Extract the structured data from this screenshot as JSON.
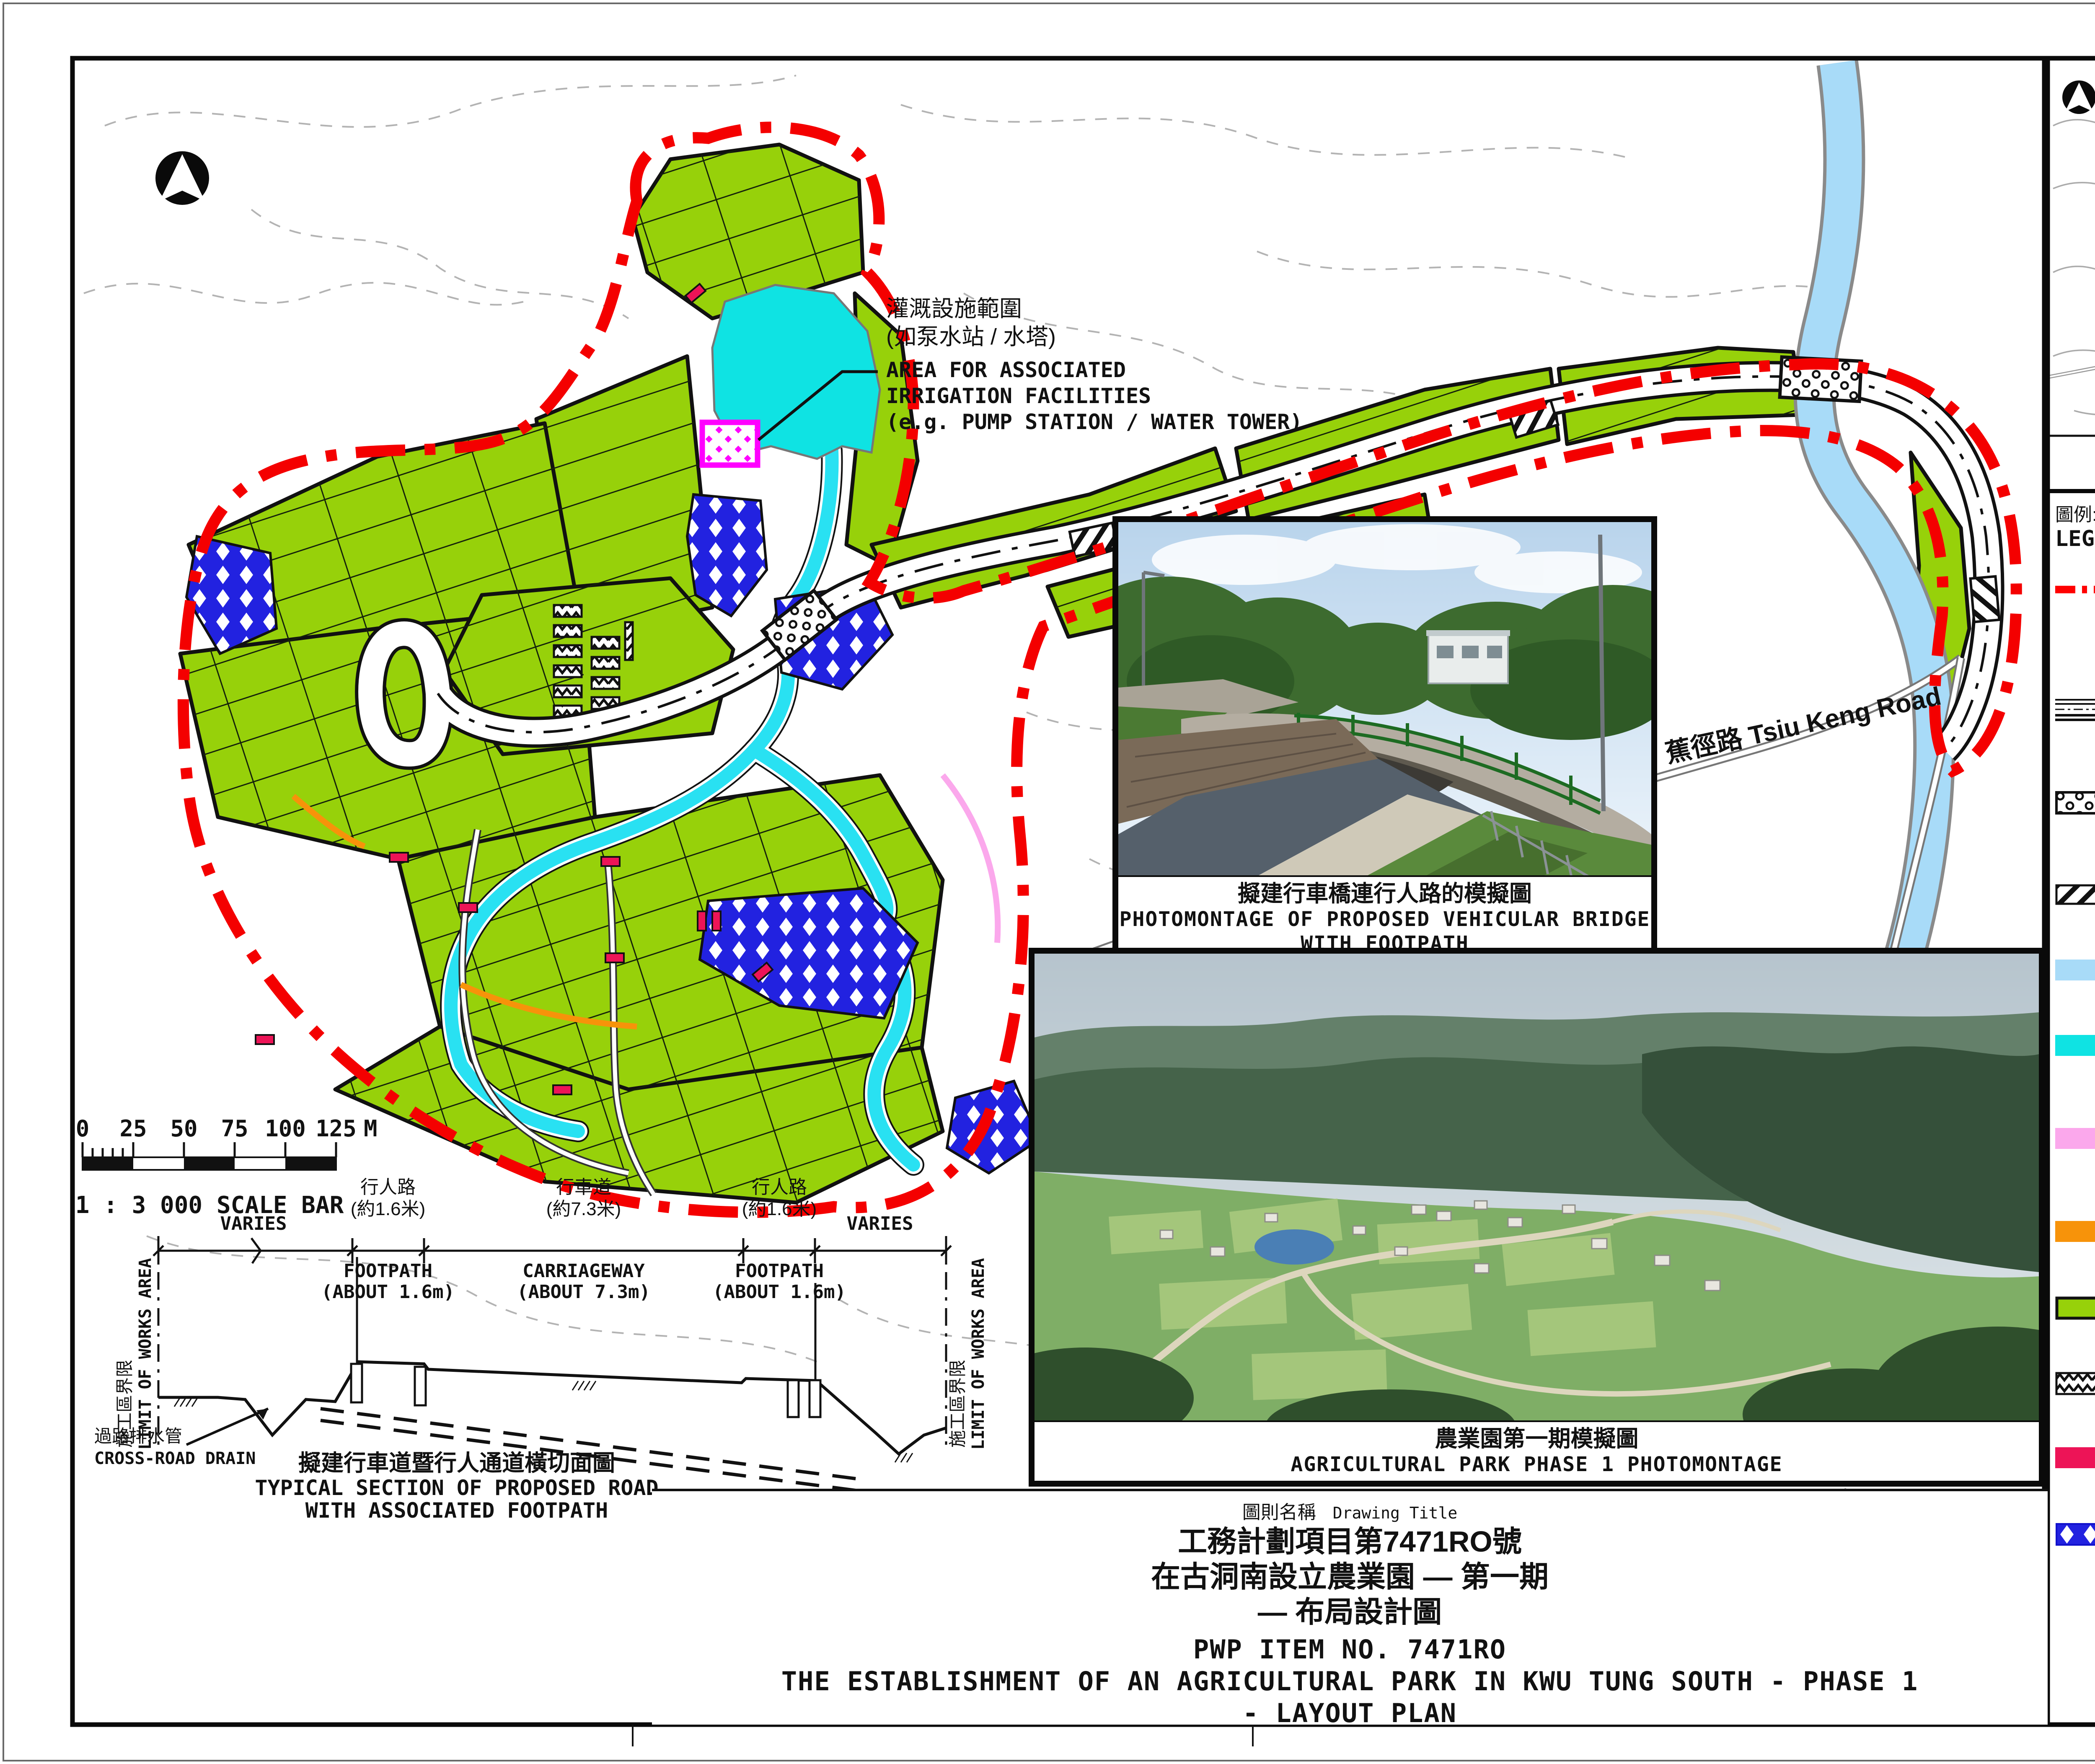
{
  "page": {
    "enclosure_label": "附件1 ENCLOSURE 1"
  },
  "key_plan": {
    "place1_zh": "長瀝",
    "place1_en": "Cheung Lek",
    "place2_zh": "蓮塘尾",
    "place2_en": "Lin Tong Mei",
    "place3_zh": "蕉徑",
    "place3_en": "Tsiu Keng",
    "caption_zh": "索引圖",
    "caption_en": "KEY PLAN"
  },
  "legend": {
    "header_zh": "圖例:",
    "header_en": "LEGEND:",
    "items": [
      {
        "id": "boundary",
        "zh": "農業園第一期擬議範圍",
        "en": "BOUNDARY OF PROPOSED AGRICULTURAL PARK",
        "en2": "(PHASE 1)",
        "color": "#ff0000"
      },
      {
        "id": "road",
        "zh": "擬建行車道暨行人通道",
        "en": "PROPOSED ROAD WITH ASSOCIATED FOOTPATH",
        "color": "#111111"
      },
      {
        "id": "bridge",
        "zh": "擬建行車橋連行人路",
        "en": "PROPOSED VEHICULAR BRIDGE WITH FOOTPATH",
        "color": "#111111"
      },
      {
        "id": "culvert",
        "zh": "擬建暗渠",
        "en": "PROPOSED CULVERT",
        "color": "#111111"
      },
      {
        "id": "river",
        "zh": "現有河道 / 河流",
        "en": "EXISTING RIVER / STREAM COURSE",
        "color": "#a8dbf8"
      },
      {
        "id": "pond",
        "zh": "擬建灌溉用蓄水池",
        "en": "PROPOSED IRRIGATION STORAGE POND",
        "color": "#0fe3e3"
      },
      {
        "id": "track",
        "zh": "現有行人通道 / 小徑 (擴闊至1.6米)",
        "en": "EXISTING FOOTPATH / TRACK",
        "en2": "(WIDENING TO 1.6m WIDE)",
        "color": "#fba8ec"
      },
      {
        "id": "footpath",
        "zh": "擬建行人路 (1.5米闊)",
        "en": "PROPOSED FOOTPATH (1.5m WIDE)",
        "color": "#f7930a"
      },
      {
        "id": "farmland",
        "zh": "擬建農田",
        "en": "PROPOSED FARMLAND",
        "color": "#97d10a"
      },
      {
        "id": "lodging",
        "zh": "擬建留宿設施",
        "en": "PROPOSED LODGING",
        "color": "#111111"
      },
      {
        "id": "storage",
        "zh": "擬建農耕貯物設施",
        "en": "PROPOSED STORAGE",
        "color": "#ed1457"
      },
      {
        "id": "tree_zone",
        "zh": "擬建樹木保存地帶",
        "en": "PROPOSED TREE PRESERVATION ZONE",
        "color": "#2222e0"
      }
    ]
  },
  "map": {
    "road_label": "蕉徑路 Tsiu Keng Road",
    "irrigation_note": {
      "zh1": "灌溉設施範圍",
      "zh2": "(如泵水站 / 水塔)",
      "en1": "AREA FOR ASSOCIATED",
      "en2": "IRRIGATION FACILITIES",
      "en3": "(e.g. PUMP STATION / WATER TOWER)"
    },
    "scale_bar": {
      "t0": "0",
      "t1": "25",
      "t2": "50",
      "t3": "75",
      "t4": "100",
      "t5": "125",
      "unit": "M",
      "label": "1 : 3 000   SCALE BAR"
    }
  },
  "section": {
    "varies_left": "VARIES",
    "varies_right": "VARIES",
    "footpath_zh": "行人路",
    "footpath_dim_zh": "(約1.6米)",
    "footpath_en": "FOOTPATH",
    "footpath_dim_en": "(ABOUT 1.6m)",
    "carriageway_zh": "行車道",
    "carriageway_dim_zh": "(約7.3米)",
    "carriageway_en": "CARRIAGEWAY",
    "carriageway_dim_en": "(ABOUT 7.3m)",
    "limit_zh": "施工區界限",
    "limit_en": "LIMIT OF WORKS AREA",
    "drain_zh": "過路排水管",
    "drain_en": "CROSS-ROAD DRAIN",
    "caption_zh": "擬建行車道暨行人通道橫切面圖",
    "caption_en1": "TYPICAL SECTION OF PROPOSED ROAD",
    "caption_en2": "WITH ASSOCIATED FOOTPATH"
  },
  "photos": {
    "bridge": {
      "caption_zh": "擬建行車橋連行人路的模擬圖",
      "caption_en1": "PHOTOMONTAGE OF PROPOSED VEHICULAR BRIDGE",
      "caption_en2": "WITH FOOTPATH"
    },
    "agpark": {
      "caption_zh": "農業園第一期模擬圖",
      "caption_en": "AGRICULTURAL PARK PHASE 1 PHOTOMONTAGE"
    }
  },
  "title_block": {
    "label_zh": "圖則名稱",
    "label_en": "Drawing Title",
    "zh1": "工務計劃項目第7471RO號",
    "zh2": "在古洞南設立農業園 — 第一期",
    "zh3": "— 布局設計圖",
    "en1": "PWP ITEM NO. 7471RO",
    "en2": "THE ESTABLISHMENT OF AN AGRICULTURAL PARK IN KWU TUNG SOUTH - PHASE 1",
    "en3": "- LAYOUT PLAN"
  },
  "colors": {
    "boundary_red": "#ff0000",
    "farmland_green": "#97d10a",
    "pond_cyan": "#0fe3e3",
    "river_blue": "#a8dbf8",
    "stream_cyan": "#29e1f2",
    "tree_zone_blue": "#2222e0",
    "storage_crimson": "#ed1457",
    "footpath_orange": "#f7930a",
    "track_pink": "#fba8ec",
    "facility_magenta": "#ff00ff"
  }
}
